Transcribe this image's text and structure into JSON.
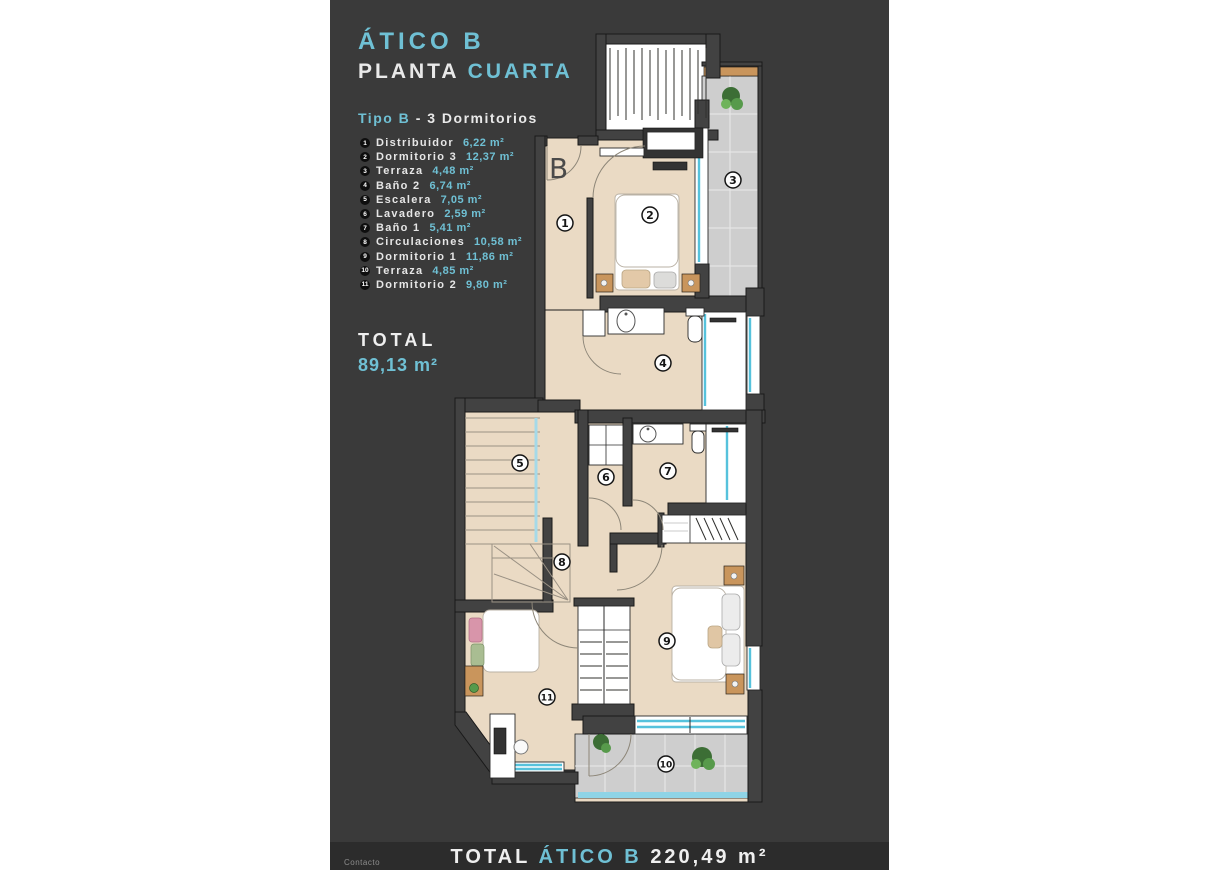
{
  "colors": {
    "accent": "#6fc0d4",
    "panel_bg": "#3a3a3a",
    "footer_bg": "#2c2c2c",
    "floor": "#eadac4",
    "wall": "#424242",
    "tile": "#cecece",
    "glass": "#56c2dc",
    "wood": "#c9955c",
    "plant": "#4e8f45",
    "text_light": "#e9e9e9"
  },
  "header": {
    "title": "ÁTICO B",
    "subtitle_plain": "PLANTA",
    "subtitle_accent": "CUARTA",
    "type_accent": "Tipo B",
    "type_rest": "- 3 Dormitorios"
  },
  "legend": {
    "items": [
      {
        "num": "1",
        "label": "Distribuidor",
        "area": "6,22 m²"
      },
      {
        "num": "2",
        "label": "Dormitorio 3",
        "area": "12,37 m²"
      },
      {
        "num": "3",
        "label": "Terraza",
        "area": "4,48 m²"
      },
      {
        "num": "4",
        "label": "Baño 2",
        "area": "6,74 m²"
      },
      {
        "num": "5",
        "label": "Escalera",
        "area": "7,05 m²"
      },
      {
        "num": "6",
        "label": "Lavadero",
        "area": "2,59 m²"
      },
      {
        "num": "7",
        "label": "Baño 1",
        "area": "5,41 m²"
      },
      {
        "num": "8",
        "label": "Circulaciones",
        "area": "10,58 m²"
      },
      {
        "num": "9",
        "label": "Dormitorio 1",
        "area": "11,86 m²"
      },
      {
        "num": "10",
        "label": "Terraza",
        "area": "4,85 m²"
      },
      {
        "num": "11",
        "label": "Dormitorio 2",
        "area": "9,80 m²"
      }
    ]
  },
  "total": {
    "label": "TOTAL",
    "value": "89,13 m²"
  },
  "footer": {
    "label": "TOTAL",
    "name_accent": "ÁTICO B",
    "value": "220,49 m²",
    "contact": "Contacto"
  },
  "plan": {
    "entrance_label": "B",
    "rooms": [
      {
        "number": "1"
      },
      {
        "number": "2"
      },
      {
        "number": "3"
      },
      {
        "number": "4"
      },
      {
        "number": "5"
      },
      {
        "number": "6"
      },
      {
        "number": "7"
      },
      {
        "number": "8"
      },
      {
        "number": "9"
      },
      {
        "number": "10"
      },
      {
        "number": "11"
      }
    ]
  }
}
